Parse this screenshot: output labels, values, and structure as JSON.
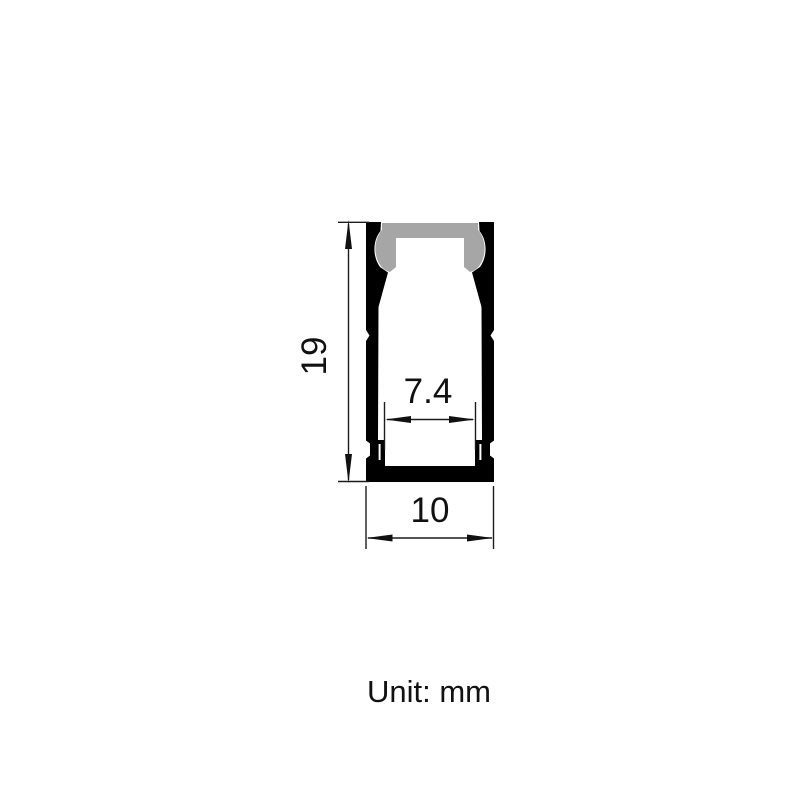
{
  "diagram": {
    "type": "technical-drawing",
    "subject": "LED aluminum profile cross-section with dimensions",
    "unit_label": "Unit: mm",
    "dimensions": {
      "height": {
        "value": "19",
        "orientation": "vertical",
        "side": "left"
      },
      "inner_width": {
        "value": "7.4",
        "orientation": "horizontal",
        "position": "inner-slot"
      },
      "outer_width": {
        "value": "10",
        "orientation": "horizontal",
        "position": "bottom-overall"
      }
    },
    "colors": {
      "outline": "#000000",
      "diffuser_gray": "#a6a6a6",
      "background": "#ffffff",
      "text": "#111111"
    }
  }
}
